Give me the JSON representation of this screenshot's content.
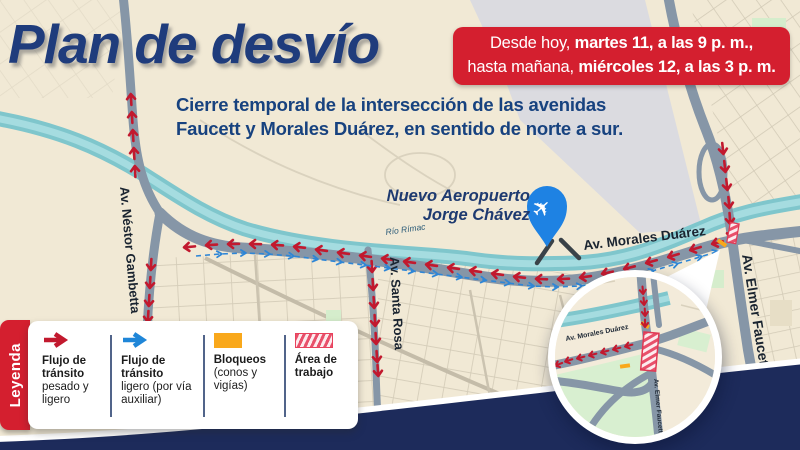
{
  "title": "Plan de desvío",
  "badge": {
    "line1_regular": "Desde hoy, ",
    "line1_bold": "martes 11, a las 9 p. m.,",
    "line2_regular": "hasta mañana, ",
    "line2_bold": "miércoles 12, a las 3 p. m."
  },
  "subtitle": {
    "line1": "Cierre temporal de la intersección de las avenidas",
    "line2": "Faucett y Morales Duárez, en sentido de norte a sur."
  },
  "map": {
    "labels": {
      "airport_line1": "Nuevo Aeropuerto",
      "airport_line2": "Jorge Chávez",
      "river": "Río Rímac",
      "av_morales": "Av. Morales Duárez",
      "av_gambetta": "Av. Néstor Gambetta",
      "av_santa_rosa": "Av. Santa Rosa",
      "av_faucett": "Av. Elmer Faucett"
    },
    "inset_labels": {
      "av_morales": "Av. Morales Duárez",
      "av_faucett": "Av. Elmer Faucett"
    },
    "icons": {
      "airplane_glyph": "✈"
    }
  },
  "legend": {
    "tab": "Leyenda",
    "items": [
      {
        "icon": "red-flow-arrow",
        "bold": "Flujo de tránsito",
        "rest": "pesado y ligero"
      },
      {
        "icon": "blue-flow-arrow",
        "bold": "Flujo de tránsito",
        "rest": "ligero (por vía auxiliar)"
      },
      {
        "icon": "blockade-swatch",
        "bold": "Bloqueos",
        "rest": "(conos y vigías)"
      },
      {
        "icon": "work-area-swatch",
        "bold": "Área de trabajo",
        "rest": ""
      }
    ]
  },
  "colors": {
    "title_navy": "#1F3C7C",
    "badge_red": "#D41F2F",
    "arrow_red": "#C2192E",
    "arrow_blue": "#2E86D6",
    "river_teal": "#83C8CE",
    "road_gray": "#8696A7",
    "band_navy": "#1D2B5B",
    "blockade_orange": "#F9A81B",
    "work_area_pink": "#E8506A",
    "pin_blue": "#1E82E3"
  }
}
